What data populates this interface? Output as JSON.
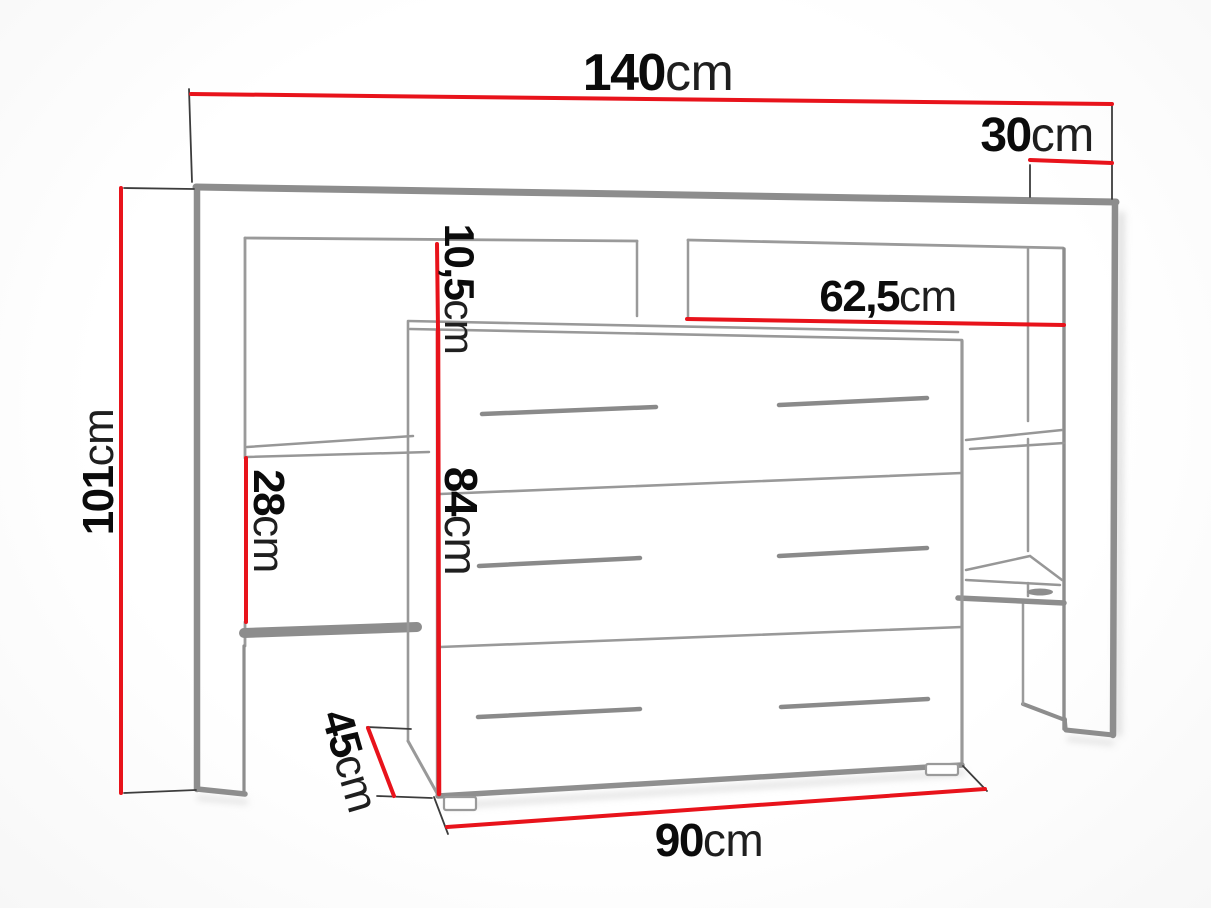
{
  "diagram": {
    "type": "furniture-dimension-drawing",
    "subject": "headboard wall unit with shelves and chest of drawers",
    "colors": {
      "dimension_line": "#e8131b",
      "structure_gray": "#8d8d8d",
      "label_text": "#101010",
      "background": "#fdfdfd"
    },
    "dimensions": [
      {
        "id": "total-width",
        "value": "140",
        "unit": "cm"
      },
      {
        "id": "top-depth",
        "value": "30",
        "unit": "cm"
      },
      {
        "id": "total-height",
        "value": "101",
        "unit": "cm"
      },
      {
        "id": "top-gap-height",
        "value": "10,5",
        "unit": "cm"
      },
      {
        "id": "inner-width",
        "value": "62,5",
        "unit": "cm"
      },
      {
        "id": "shelf-opening-height",
        "value": "28",
        "unit": "cm"
      },
      {
        "id": "dresser-height",
        "value": "84",
        "unit": "cm"
      },
      {
        "id": "side-depth",
        "value": "45",
        "unit": "cm"
      },
      {
        "id": "dresser-width",
        "value": "90",
        "unit": "cm"
      }
    ]
  }
}
